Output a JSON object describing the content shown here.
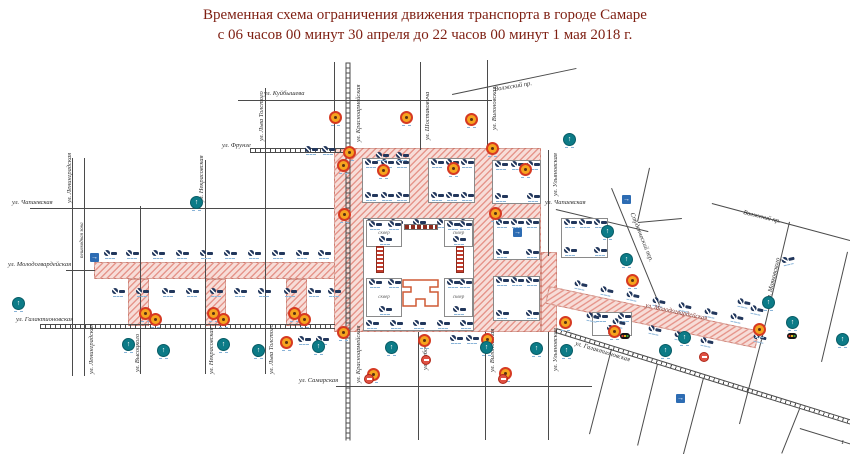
{
  "title": {
    "line1": "Временная схема ограничения движения транспорта в городе Самаре",
    "line2": "с 06 часов 00 минут 30 апреля до 22 часов 00 минут 1 мая 2018 г."
  },
  "glyphs": {
    "arrow_up": "↑",
    "arrow_right": "→"
  },
  "colors": {
    "title": "#7e1f12",
    "pink_hatch": "#d85c4e",
    "navy": "#22375c",
    "teal": "#0c7b87",
    "orange": "#f6a41f",
    "orange_ring": "#d63a22",
    "blue": "#2d6cb3",
    "red": "#df5143",
    "tribune": "#c23b2c",
    "theater": "#cf5a35"
  },
  "streets": [
    {
      "x1": 238,
      "y1": 100,
      "x2": 492,
      "y2": 100
    },
    {
      "x1": 250,
      "y1": 150,
      "x2": 345,
      "y2": 150,
      "tram": true
    },
    {
      "x1": 30,
      "y1": 208,
      "x2": 334,
      "y2": 208
    },
    {
      "x1": 556,
      "y1": 209,
      "x2": 648,
      "y2": 231
    },
    {
      "x1": 66,
      "y1": 270,
      "x2": 95,
      "y2": 270
    },
    {
      "x1": 40,
      "y1": 326,
      "x2": 335,
      "y2": 326,
      "tram": true
    },
    {
      "x1": 336,
      "y1": 386,
      "x2": 592,
      "y2": 386
    },
    {
      "x1": 73,
      "y1": 158,
      "x2": 73,
      "y2": 376
    },
    {
      "x1": 85,
      "y1": 158,
      "x2": 85,
      "y2": 376
    },
    {
      "x1": 141,
      "y1": 206,
      "x2": 141,
      "y2": 374
    },
    {
      "x1": 206,
      "y1": 160,
      "x2": 206,
      "y2": 374
    },
    {
      "x1": 266,
      "y1": 88,
      "x2": 266,
      "y2": 374
    },
    {
      "x1": 348,
      "y1": 62,
      "x2": 348,
      "y2": 440,
      "tram": true
    },
    {
      "x1": 335,
      "y1": 62,
      "x2": 335,
      "y2": 148
    },
    {
      "x1": 421,
      "y1": 62,
      "x2": 421,
      "y2": 150
    },
    {
      "x1": 419,
      "y1": 332,
      "x2": 419,
      "y2": 440
    },
    {
      "x1": 488,
      "y1": 60,
      "x2": 488,
      "y2": 150
    },
    {
      "x1": 486,
      "y1": 332,
      "x2": 486,
      "y2": 440
    },
    {
      "x1": 549,
      "y1": 150,
      "x2": 549,
      "y2": 256
    },
    {
      "x1": 549,
      "y1": 332,
      "x2": 549,
      "y2": 440
    },
    {
      "x1": 452,
      "y1": 94,
      "x2": 576,
      "y2": 68
    },
    {
      "x1": 612,
      "y1": 188,
      "x2": 660,
      "y2": 305
    },
    {
      "x1": 650,
      "y1": 168,
      "x2": 638,
      "y2": 222
    },
    {
      "x1": 638,
      "y1": 222,
      "x2": 682,
      "y2": 218
    },
    {
      "x1": 712,
      "y1": 203,
      "x2": 850,
      "y2": 240
    },
    {
      "x1": 790,
      "y1": 222,
      "x2": 762,
      "y2": 340
    },
    {
      "x1": 762,
      "y1": 340,
      "x2": 740,
      "y2": 424
    },
    {
      "x1": 848,
      "y1": 252,
      "x2": 822,
      "y2": 362
    },
    {
      "x1": 556,
      "y1": 330,
      "x2": 852,
      "y2": 422,
      "tram": true
    },
    {
      "x1": 612,
      "y1": 349,
      "x2": 590,
      "y2": 434
    },
    {
      "x1": 658,
      "y1": 364,
      "x2": 638,
      "y2": 446
    },
    {
      "x1": 704,
      "y1": 378,
      "x2": 684,
      "y2": 454
    },
    {
      "x1": 800,
      "y1": 409,
      "x2": 782,
      "y2": 454
    },
    {
      "x1": 800,
      "y1": 428,
      "x2": 852,
      "y2": 444
    }
  ],
  "street_labels": [
    {
      "t": "ул. Куйбышева",
      "x": 264,
      "y": 91,
      "r": 0
    },
    {
      "t": "ул. Фрунзе",
      "x": 222,
      "y": 143,
      "r": 0
    },
    {
      "t": "ул. Чапаевская",
      "x": 12,
      "y": 200,
      "r": 0
    },
    {
      "t": "ул. Чапаевская",
      "x": 545,
      "y": 200,
      "r": 0
    },
    {
      "t": "ул. Молодогвардейская",
      "x": 8,
      "y": 262,
      "r": 0
    },
    {
      "t": "ул. Галактионовская",
      "x": 16,
      "y": 317,
      "r": 0
    },
    {
      "t": "ул. Самарская",
      "x": 299,
      "y": 378,
      "r": 0
    },
    {
      "t": "ул. Ленинградская",
      "x": 67,
      "y": 203,
      "r": -90
    },
    {
      "t": "пешеходная зона",
      "x": 80,
      "y": 258,
      "r": -90,
      "s": 5
    },
    {
      "t": "ул. Ленинградская",
      "x": 89,
      "y": 374,
      "r": -90
    },
    {
      "t": "ул. Высоцкого",
      "x": 135,
      "y": 372,
      "r": -90
    },
    {
      "t": "ул. Некрасовская",
      "x": 199,
      "y": 202,
      "r": -90
    },
    {
      "t": "ул. Некрасовская",
      "x": 209,
      "y": 374,
      "r": -90
    },
    {
      "t": "ул. Льва Толстого",
      "x": 259,
      "y": 141,
      "r": -90
    },
    {
      "t": "ул. Льва Толстого",
      "x": 269,
      "y": 374,
      "r": -90
    },
    {
      "t": "ул. Красноармейская",
      "x": 356,
      "y": 142,
      "r": -90
    },
    {
      "t": "ул. Красноармейская",
      "x": 356,
      "y": 383,
      "r": -90
    },
    {
      "t": "ул. Шостаковича",
      "x": 425,
      "y": 140,
      "r": -90
    },
    {
      "t": "ул. Рабочая",
      "x": 423,
      "y": 370,
      "r": -90
    },
    {
      "t": "ул. Вилоновская",
      "x": 492,
      "y": 130,
      "r": -90
    },
    {
      "t": "ул. Вилоновская",
      "x": 490,
      "y": 372,
      "r": -90
    },
    {
      "t": "ул. Ульяновская",
      "x": 553,
      "y": 196,
      "r": -90
    },
    {
      "t": "ул. Ульяновская",
      "x": 553,
      "y": 371,
      "r": -90
    },
    {
      "t": "Волжский пр.",
      "x": 494,
      "y": 87,
      "r": -9
    },
    {
      "t": "Волжский пр.",
      "x": 744,
      "y": 210,
      "r": 14
    },
    {
      "t": "Студенческий пер.",
      "x": 634,
      "y": 212,
      "r": 68
    },
    {
      "t": "ул. Маяковского",
      "x": 766,
      "y": 300,
      "r": -77
    },
    {
      "t": "ул. Галактионовская",
      "x": 576,
      "y": 341,
      "r": 17
    },
    {
      "t": "ул. Молодогвардейская",
      "x": 646,
      "y": 303,
      "r": 12,
      "c": "#7a2a22"
    },
    {
      "t": "1",
      "x": 841,
      "y": 440,
      "r": 0
    }
  ],
  "pink_zones": [
    [
      94,
      262,
      252,
      17,
      0
    ],
    [
      334,
      148,
      207,
      184,
      0
    ],
    [
      541,
      252,
      16,
      80,
      0
    ],
    [
      549,
      286,
      215,
      18,
      12
    ],
    [
      128,
      279,
      21,
      47,
      0
    ],
    [
      205,
      279,
      21,
      47,
      0
    ],
    [
      286,
      279,
      21,
      47,
      0
    ]
  ],
  "blocks": [
    {
      "x": 362,
      "y": 158,
      "w": 48,
      "h": 45,
      "signs": 6,
      "border": true
    },
    {
      "x": 428,
      "y": 158,
      "w": 47,
      "h": 45,
      "signs": 6,
      "border": true
    },
    {
      "x": 492,
      "y": 160,
      "w": 49,
      "h": 44,
      "signs": 5,
      "border": true
    },
    {
      "x": 363,
      "y": 218,
      "w": 111,
      "h": 113,
      "signs": 10,
      "border": true
    },
    {
      "x": 493,
      "y": 218,
      "w": 47,
      "h": 42,
      "signs": 5,
      "border": true
    },
    {
      "x": 493,
      "y": 276,
      "w": 47,
      "h": 45,
      "signs": 5,
      "border": true
    },
    {
      "x": 366,
      "y": 220,
      "w": 36,
      "h": 27,
      "signs": 3,
      "border": true,
      "label": "сквер"
    },
    {
      "x": 444,
      "y": 220,
      "w": 29,
      "h": 27,
      "signs": 3,
      "border": true,
      "label": "сквер"
    },
    {
      "x": 366,
      "y": 278,
      "w": 36,
      "h": 39,
      "signs": 3,
      "border": true,
      "label": "сквер"
    },
    {
      "x": 444,
      "y": 278,
      "w": 29,
      "h": 39,
      "signs": 3,
      "border": true,
      "label": "сквер"
    },
    {
      "x": 561,
      "y": 218,
      "w": 47,
      "h": 40,
      "signs": 5,
      "border": true
    },
    {
      "x": 592,
      "y": 312,
      "w": 40,
      "h": 24,
      "signs": 3,
      "border": true
    }
  ],
  "icons": {
    "stop": [
      [
        104,
        250
      ],
      [
        126,
        250
      ],
      [
        152,
        250
      ],
      [
        176,
        250
      ],
      [
        200,
        250
      ],
      [
        224,
        250
      ],
      [
        248,
        250
      ],
      [
        272,
        250
      ],
      [
        296,
        250
      ],
      [
        318,
        250
      ],
      [
        112,
        288
      ],
      [
        136,
        288
      ],
      [
        162,
        288
      ],
      [
        186,
        288
      ],
      [
        210,
        288
      ],
      [
        234,
        288
      ],
      [
        258,
        288
      ],
      [
        284,
        288
      ],
      [
        308,
        288
      ],
      [
        328,
        288
      ],
      [
        305,
        146
      ],
      [
        322,
        146
      ],
      [
        376,
        152
      ],
      [
        396,
        152
      ],
      [
        574,
        281,
        12
      ],
      [
        600,
        287,
        12
      ],
      [
        626,
        292,
        12
      ],
      [
        652,
        298,
        12
      ],
      [
        678,
        303,
        12
      ],
      [
        704,
        309,
        12
      ],
      [
        730,
        314,
        12
      ],
      [
        586,
        313,
        12
      ],
      [
        612,
        319,
        12
      ],
      [
        648,
        326,
        12
      ],
      [
        674,
        332,
        12
      ],
      [
        700,
        338,
        12
      ],
      [
        298,
        336
      ],
      [
        316,
        336
      ],
      [
        450,
        335
      ],
      [
        466,
        335
      ],
      [
        737,
        299,
        12
      ],
      [
        750,
        306,
        12
      ],
      [
        753,
        334,
        12
      ],
      [
        782,
        256,
        -13
      ]
    ],
    "orange": [
      [
        329,
        111
      ],
      [
        400,
        111
      ],
      [
        465,
        113
      ],
      [
        343,
        146
      ],
      [
        337,
        159
      ],
      [
        486,
        142
      ],
      [
        377,
        164
      ],
      [
        447,
        162
      ],
      [
        519,
        163
      ],
      [
        338,
        208
      ],
      [
        489,
        207
      ],
      [
        139,
        307
      ],
      [
        149,
        313
      ],
      [
        207,
        307
      ],
      [
        217,
        313
      ],
      [
        288,
        307
      ],
      [
        298,
        313
      ],
      [
        280,
        336
      ],
      [
        337,
        326
      ],
      [
        418,
        334
      ],
      [
        481,
        333
      ],
      [
        559,
        316
      ],
      [
        367,
        368
      ],
      [
        499,
        367
      ],
      [
        626,
        274
      ],
      [
        753,
        323
      ],
      [
        608,
        325
      ]
    ],
    "teal": [
      [
        12,
        297
      ],
      [
        190,
        196
      ],
      [
        563,
        133
      ],
      [
        122,
        338
      ],
      [
        157,
        344
      ],
      [
        217,
        338
      ],
      [
        252,
        344
      ],
      [
        312,
        340
      ],
      [
        385,
        341
      ],
      [
        480,
        341
      ],
      [
        530,
        342
      ],
      [
        560,
        344
      ],
      [
        620,
        253
      ],
      [
        601,
        225
      ],
      [
        678,
        331
      ],
      [
        659,
        344
      ],
      [
        762,
        296
      ],
      [
        786,
        316
      ],
      [
        836,
        333
      ]
    ],
    "blue": [
      [
        90,
        253
      ],
      [
        513,
        228
      ],
      [
        622,
        195
      ],
      [
        676,
        394
      ]
    ],
    "red": [
      [
        699,
        352
      ],
      [
        364,
        374
      ],
      [
        498,
        374
      ],
      [
        421,
        355
      ]
    ],
    "light": [
      [
        620,
        333
      ],
      [
        787,
        333
      ]
    ]
  },
  "structures": {
    "tribunes": [
      [
        376,
        246
      ],
      [
        456,
        246
      ]
    ],
    "stage": [
      404,
      224,
      34,
      6
    ],
    "theater": [
      397,
      279
    ]
  }
}
